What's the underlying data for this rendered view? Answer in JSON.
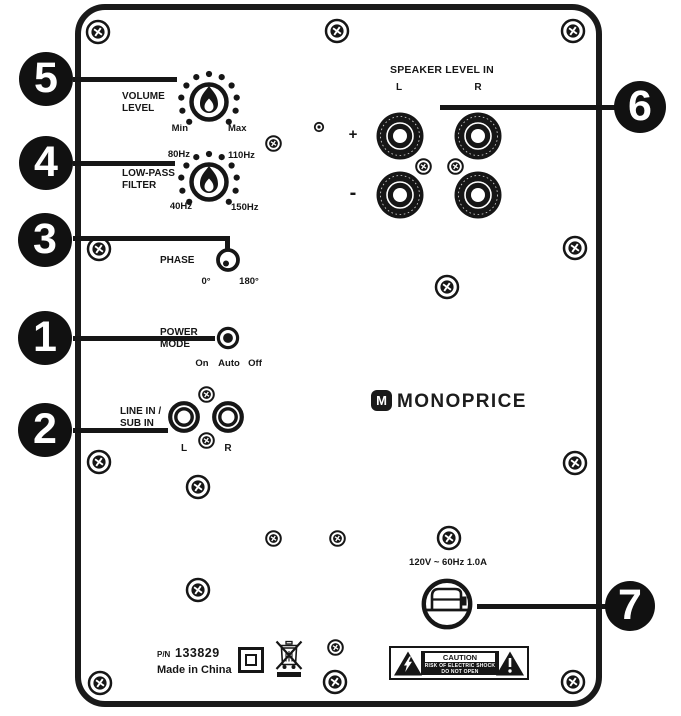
{
  "colors": {
    "ink": "#161616",
    "panel_bg": "#ffffff"
  },
  "branding": {
    "icon_letter": "M",
    "name": "MONOPRICE"
  },
  "controls": {
    "volume": {
      "title_line1": "VOLUME",
      "title_line2": "LEVEL",
      "min_label": "Min",
      "max_label": "Max"
    },
    "low_pass": {
      "title_line1": "LOW-PASS",
      "title_line2": "FILTER",
      "top_left": "80Hz",
      "top_right": "110Hz",
      "bottom_left": "40Hz",
      "bottom_right": "150Hz"
    },
    "phase": {
      "title": "PHASE",
      "left_label": "0°",
      "right_label": "180°"
    },
    "power_mode": {
      "title_line1": "POWER",
      "title_line2": "MODE",
      "options": [
        "On",
        "Auto",
        "Off"
      ]
    },
    "line_in": {
      "title_line1": "LINE IN /",
      "title_line2": "SUB IN",
      "left_label": "L",
      "right_label": "R"
    },
    "speaker_in": {
      "title": "SPEAKER LEVEL IN",
      "left_label": "L",
      "right_label": "R",
      "plus_label": "+",
      "minus_label": "-"
    }
  },
  "power_rating": "120V ~ 60Hz 1.0A",
  "caution": {
    "header": "CAUTION",
    "line1": "RISK OF ELECTRIC SHOCK",
    "line2": "DO NOT OPEN"
  },
  "footer": {
    "pn_label": "P/N",
    "pn": "133829",
    "made_in": "Made in China"
  },
  "callouts": [
    {
      "label": "5",
      "cx": 46,
      "cy": 79,
      "r": 27,
      "segments": [
        {
          "x": 73,
          "y": 76.5,
          "w": 104,
          "h": 5
        }
      ]
    },
    {
      "label": "4",
      "cx": 46,
      "cy": 163,
      "r": 27,
      "segments": [
        {
          "x": 73,
          "y": 160.5,
          "w": 102,
          "h": 5
        }
      ]
    },
    {
      "label": "3",
      "cx": 45,
      "cy": 240,
      "r": 27,
      "segments": [
        {
          "x": 73,
          "y": 235.5,
          "w": 157,
          "h": 5
        },
        {
          "x": 225,
          "y": 238,
          "w": 5,
          "h": 13
        }
      ]
    },
    {
      "label": "1",
      "cx": 45,
      "cy": 338,
      "r": 27,
      "segments": [
        {
          "x": 73,
          "y": 335.5,
          "w": 142,
          "h": 5
        }
      ]
    },
    {
      "label": "2",
      "cx": 45,
      "cy": 430,
      "r": 27,
      "segments": [
        {
          "x": 73,
          "y": 427.5,
          "w": 95,
          "h": 5
        }
      ]
    },
    {
      "label": "6",
      "cx": 640,
      "cy": 107,
      "r": 26,
      "segments": [
        {
          "x": 440,
          "y": 104.5,
          "w": 178,
          "h": 5
        }
      ]
    },
    {
      "label": "7",
      "cx": 630,
      "cy": 606,
      "r": 25,
      "segments": [
        {
          "x": 477,
          "y": 603.5,
          "w": 130,
          "h": 5
        }
      ]
    }
  ],
  "screws": {
    "large": [
      [
        98,
        32
      ],
      [
        337,
        31
      ],
      [
        573,
        31
      ],
      [
        99,
        249
      ],
      [
        575,
        248
      ],
      [
        447,
        287
      ],
      [
        99,
        462
      ],
      [
        575,
        463
      ],
      [
        198,
        487
      ],
      [
        449,
        538
      ],
      [
        198,
        590
      ],
      [
        100,
        683
      ],
      [
        335,
        682
      ],
      [
        573,
        682
      ]
    ],
    "medium": [
      [
        273,
        143
      ],
      [
        423,
        166
      ],
      [
        455,
        166
      ],
      [
        206,
        394
      ],
      [
        206,
        440
      ],
      [
        273,
        538
      ],
      [
        337,
        538
      ],
      [
        335,
        647
      ]
    ],
    "tiny": [
      [
        319,
        127
      ]
    ]
  }
}
